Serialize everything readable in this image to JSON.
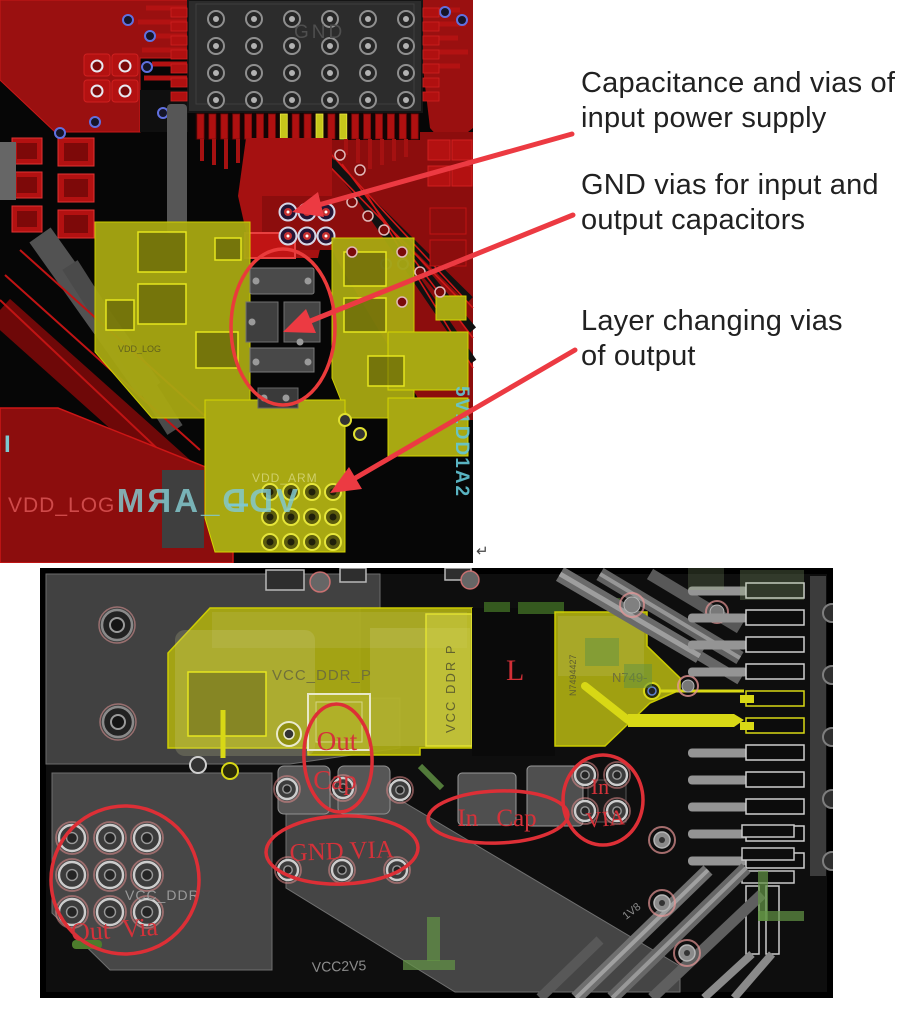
{
  "annotations": {
    "text_color": "#212121",
    "arrow_color": "#ec3a42",
    "items": [
      {
        "lines": [
          "Capacitance and vias of",
          "input power supply"
        ]
      },
      {
        "lines": [
          "GND vias for input and",
          "output capacitors"
        ]
      },
      {
        "lines": [
          "Layer changing vias",
          "of output"
        ]
      }
    ]
  },
  "top_board": {
    "chip_label": "GND",
    "net_vdd_arm": "VDD_ARM",
    "net_vdd_log": "VDD_LOG",
    "net_vdd_arm_mirrored": "VDD_ARM",
    "net_side_vertical": "5V1DD1A2",
    "left_edge_mark": "I",
    "return_mark": "↵",
    "colors": {
      "board_background": "#060606",
      "copper_red": "#8c0d0d",
      "trace_red": "#b31212",
      "yellow_pour": "#a8a812",
      "silkscreen_cyan": "#7cc8d0"
    }
  },
  "bottom_board": {
    "net_vcc_ddr_p": "VCC_DDR_P",
    "net_vcc_ddr_p_vertical": "VCC DDR P",
    "inductor_ref": "L",
    "part_ref": "N749-",
    "part_ref_rotated": "N7494427",
    "net_vcc_ddr": "VCC_DDR",
    "net_vcc2v5": "VCC2V5",
    "net_1v8": "1V8",
    "callouts": {
      "out_cap_line1": "Out",
      "out_cap_line2": "Cap",
      "gnd_via": "GND VIA",
      "in_cap": "In Cap",
      "in_via_line1": "In",
      "in_via_line2": "VIA",
      "out_via": "Out Via"
    },
    "colors": {
      "annotation_red": "#d4323a",
      "background": "#0e0e0e",
      "pour_gray": "#474747",
      "yellow_pour": "#aaaa12",
      "green_overlay": "#4c7c2c"
    }
  }
}
